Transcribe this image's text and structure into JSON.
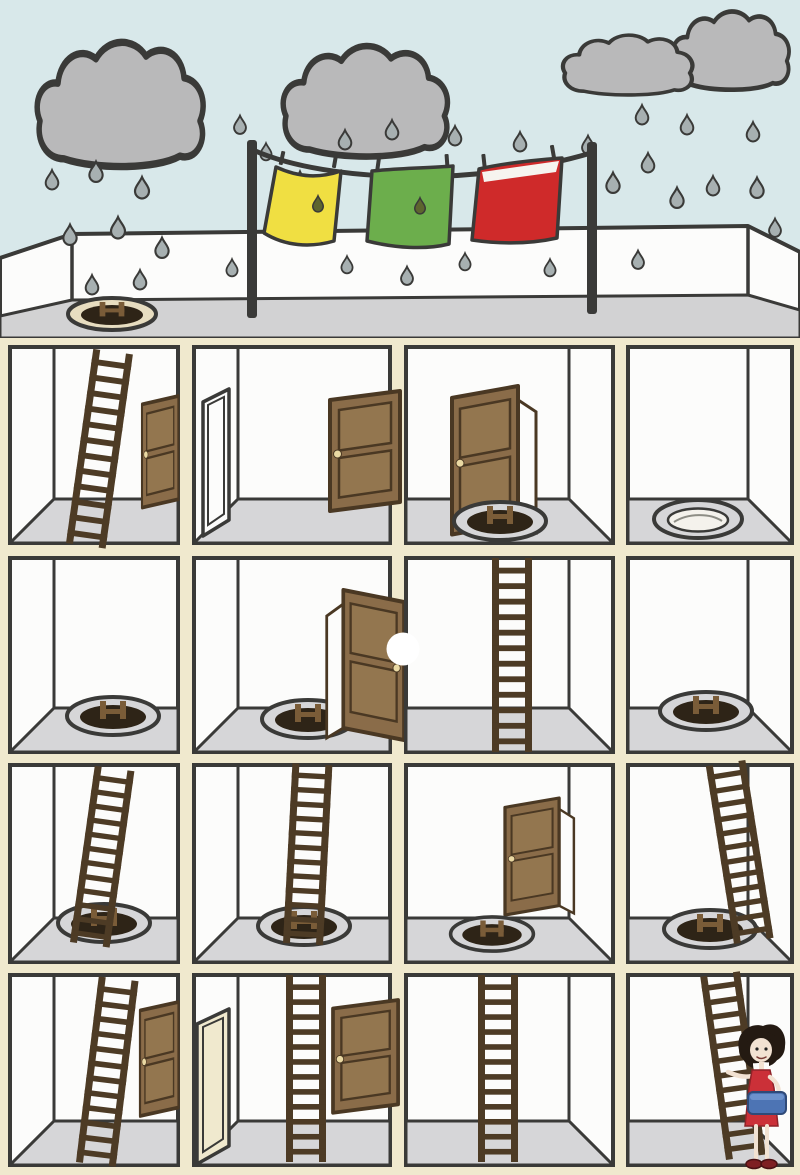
{
  "scene": {
    "type": "cartoon-illustration",
    "description": "Cross-section of a four-storey building on a rainy day. Laundry dries on a rooftop clothesline between two poles while rain falls from three grey clouds. Rooms are connected by wooden ladders, round floor hatches and brown doors. A woman carrying a laundry basket stands in the bottom-right room.",
    "weather": {
      "clouds": 3,
      "raining": true,
      "raindrop_count": 31
    },
    "clothesline": {
      "poles": 2,
      "towels": [
        {
          "color_name": "yellow",
          "hex": "#f0df42",
          "wet_drop": true
        },
        {
          "color_name": "green",
          "hex": "#6cae4c",
          "wet_drop": true
        },
        {
          "color_name": "red",
          "hex": "#cf2a2a",
          "wet_drop": false
        }
      ]
    },
    "roof": {
      "parapet": true,
      "hatch": "open-with-ladder-top"
    },
    "floors": [
      {
        "floor": 1,
        "rooms": [
          {
            "col": 1,
            "contents": [
              "ladder-to-roof",
              "closed-door"
            ]
          },
          {
            "col": 2,
            "contents": [
              "open-door-frame",
              "closed-door"
            ]
          },
          {
            "col": 3,
            "contents": [
              "open-door",
              "floor-hatch-with-ladder"
            ]
          },
          {
            "col": 4,
            "contents": [
              "open-floor-hatch-empty"
            ]
          }
        ]
      },
      {
        "floor": 2,
        "rooms": [
          {
            "col": 1,
            "contents": [
              "floor-hatch-with-ladder"
            ]
          },
          {
            "col": 2,
            "contents": [
              "floor-hatch-with-ladder",
              "open-door",
              "white-dot"
            ]
          },
          {
            "col": 3,
            "contents": [
              "ladder-to-ceiling"
            ]
          },
          {
            "col": 4,
            "contents": [
              "floor-hatch-with-ladder"
            ]
          }
        ]
      },
      {
        "floor": 3,
        "rooms": [
          {
            "col": 1,
            "contents": [
              "ladder-to-ceiling",
              "floor-hatch"
            ]
          },
          {
            "col": 2,
            "contents": [
              "ladder-to-ceiling",
              "floor-hatch"
            ]
          },
          {
            "col": 3,
            "contents": [
              "open-door",
              "floor-hatch-with-ladder"
            ]
          },
          {
            "col": 4,
            "contents": [
              "ladder-to-ceiling",
              "floor-hatch"
            ]
          }
        ]
      },
      {
        "floor": 4,
        "rooms": [
          {
            "col": 1,
            "contents": [
              "ladder-to-ceiling",
              "closed-door"
            ]
          },
          {
            "col": 2,
            "contents": [
              "open-door",
              "ladder-to-ceiling",
              "closed-door"
            ]
          },
          {
            "col": 3,
            "contents": [
              "ladder-to-ceiling"
            ]
          },
          {
            "col": 4,
            "contents": [
              "ladder-to-ceiling",
              "woman-with-laundry-basket"
            ]
          }
        ]
      }
    ],
    "character": {
      "type": "woman",
      "holding": "laundry-basket",
      "hair": "dark bob",
      "dress_hex": "#cb3038",
      "basket_hex": "#4d74b4"
    }
  },
  "colors": {
    "sky": "#d8e8ea",
    "cloud": "#b9b9ba",
    "ink": "#3a3a38",
    "white": "#fcfcfb",
    "deck": "#d2d2d3",
    "beam": "#f0e9ce",
    "floor": "#d6d6d8",
    "hole": "#2e2417",
    "ladder": "#4d3b25",
    "ltop": "#7a5c38",
    "doorbrown": "#8a6c49",
    "doorpanel": "#93764f",
    "doordark": "#4a3823",
    "knob": "#ead9a3",
    "yellow": "#f0df42",
    "green": "#6cae4c",
    "red": "#cf2a2a",
    "dropfill": "#a7b0b1",
    "dropdark": "#5d652e",
    "hair": "#241a12",
    "skin": "#f2e2d2",
    "dress": "#cb3038",
    "basket": "#4d74b4",
    "shoe": "#7e1f23"
  }
}
